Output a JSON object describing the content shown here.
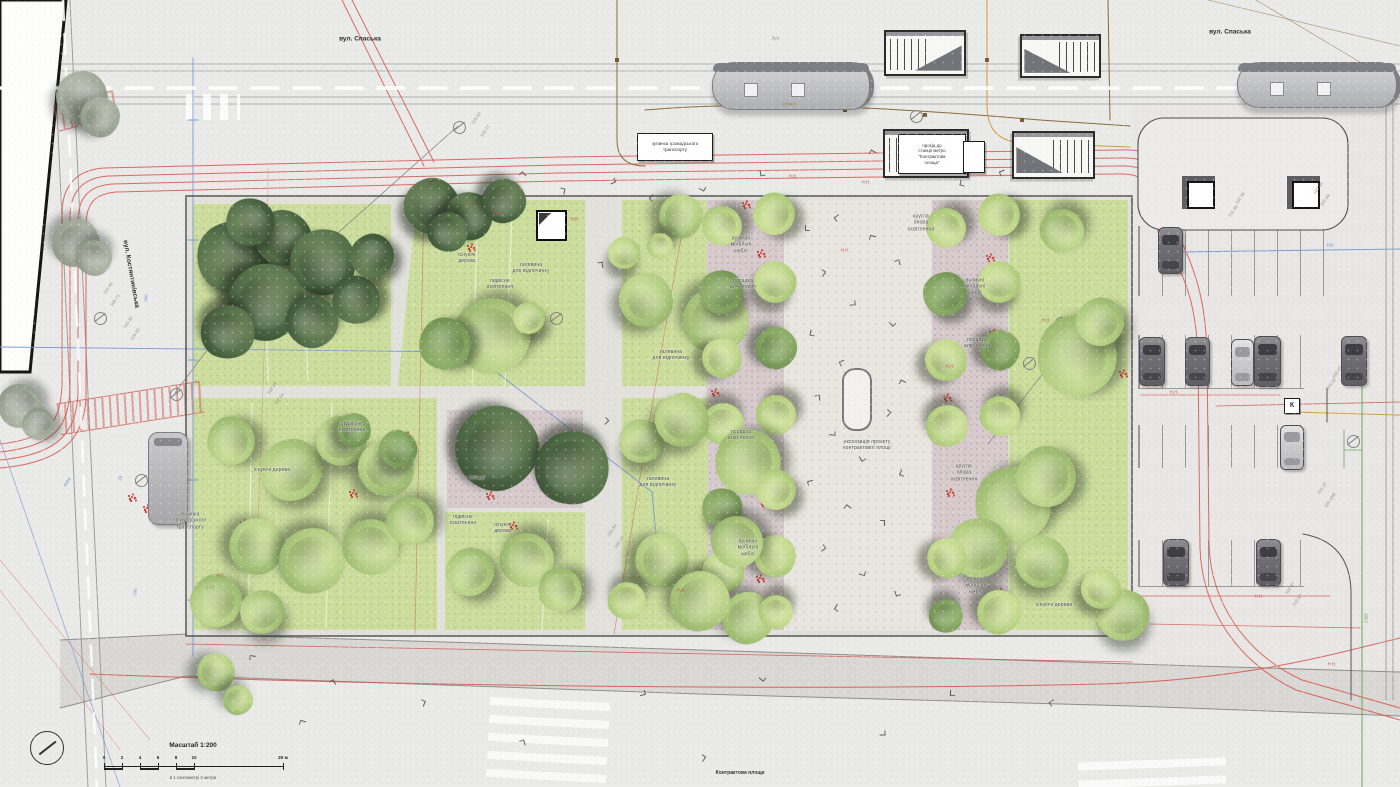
{
  "meta": {
    "scale_title": "Масштаб 1:200",
    "scale_caption": "в 1 сантиметрі  2  метри",
    "scale_ticks": [
      "0",
      "2",
      "4",
      "6",
      "8",
      "10",
      "20 м"
    ],
    "plan_caption": "Контрактова площа"
  },
  "colors": {
    "lawn": "#ccdd9d",
    "alley_paving": "#d7cbce",
    "tree_dark": "#4f6847",
    "tree_light": "#a9c57d",
    "red_utility_line": "#d9534a",
    "blue_geodetic_line": "#7a9ad1",
    "orange_utility_line": "#d99a3d",
    "green_utility_line": "#67a85b",
    "flowers": "#cf4038"
  },
  "street_labels": [
    {
      "t": "вул. Спаська",
      "x": 360,
      "y": 39,
      "rot": 0
    },
    {
      "t": "вул. Спаська",
      "x": 1230,
      "y": 32,
      "rot": 0
    },
    {
      "t": "вул. Костянтинівська",
      "x": 131,
      "y": 274,
      "rot": 80
    }
  ],
  "boxed_labels": [
    {
      "t": "зупинка громадського\nтранспорту",
      "x": 637,
      "y": 133,
      "w": 74,
      "h": 26,
      "fs": 4.6
    },
    {
      "t": "прохід до\nстанції метро\n\"Контрактова\nплоща\"",
      "x": 898,
      "y": 134,
      "w": 66,
      "h": 38,
      "fs": 4.4
    },
    {
      "t": "",
      "x": 963,
      "y": 141,
      "w": 20,
      "h": 30,
      "fs": 4
    },
    {
      "t": "К",
      "x": 1284,
      "y": 398,
      "w": 14,
      "h": 14,
      "fs": 7,
      "cls": "k"
    }
  ],
  "plan_labels": [
    {
      "t": "існуючі\nдерева",
      "x": 467,
      "y": 258
    },
    {
      "t": "галявина\nдля відпочинку",
      "x": 531,
      "y": 268
    },
    {
      "t": "підвісне\nосвітлення",
      "x": 500,
      "y": 284
    },
    {
      "t": "галявина\nдля відпочинку",
      "x": 671,
      "y": 355
    },
    {
      "t": "існуючі дерева",
      "x": 272,
      "y": 470
    },
    {
      "t": "підвісне\nосвітлення",
      "x": 352,
      "y": 427
    },
    {
      "t": "площа",
      "x": 477,
      "y": 478
    },
    {
      "t": "підвісне\nосвітлення",
      "x": 463,
      "y": 520
    },
    {
      "t": "існуючі\nдерева",
      "x": 503,
      "y": 528
    },
    {
      "t": "галявина\nдля відпочинку",
      "x": 658,
      "y": 482
    },
    {
      "t": "вуличні\nмобільні\nмеблі",
      "x": 741,
      "y": 245
    },
    {
      "t": "посадка\nалеї ясеня",
      "x": 743,
      "y": 284
    },
    {
      "t": "посадка\nалеї ясеня",
      "x": 741,
      "y": 435
    },
    {
      "t": "вуличні\nмобільні\nмеблі",
      "x": 748,
      "y": 548
    },
    {
      "t": "кругла\nопора\nосвітлення",
      "x": 921,
      "y": 223
    },
    {
      "t": "вуличні\nмобільні\nмеблі",
      "x": 975,
      "y": 287
    },
    {
      "t": "посадка\nалеї ясеня",
      "x": 977,
      "y": 343
    },
    {
      "t": "кругла\nопора\nосвітлення",
      "x": 964,
      "y": 473
    },
    {
      "t": "вуличні\nмобільні\nмеблі",
      "x": 976,
      "y": 586
    },
    {
      "t": "існуючі дерева",
      "x": 1054,
      "y": 605
    },
    {
      "t": "експозиція проекту\nконтрактової площі",
      "x": 867,
      "y": 445
    },
    {
      "t": "зупинка\nгромадського\nтранспорту",
      "x": 190,
      "y": 521
    }
  ],
  "tiny_labels": [
    {
      "t": "Н.Н.",
      "x": 497,
      "y": 213,
      "rot": 0,
      "c": "red"
    },
    {
      "t": "Н.Н.",
      "x": 575,
      "y": 219,
      "rot": 0,
      "c": "red"
    },
    {
      "t": "Н.Н.",
      "x": 845,
      "y": 250,
      "rot": 0,
      "c": "red"
    },
    {
      "t": "Н.Н.",
      "x": 866,
      "y": 182,
      "rot": 0,
      "c": "red"
    },
    {
      "t": "Н.Н.",
      "x": 950,
      "y": 366,
      "rot": 0,
      "c": "red"
    },
    {
      "t": "Н.Н.",
      "x": 1046,
      "y": 320,
      "rot": 0,
      "c": "red"
    },
    {
      "t": "Н.Н.",
      "x": 1174,
      "y": 392,
      "rot": 0,
      "c": "red"
    },
    {
      "t": "Н.Н.",
      "x": 1259,
      "y": 596,
      "rot": 0,
      "c": "red"
    },
    {
      "t": "Н.Н.",
      "x": 1332,
      "y": 664,
      "rot": 0,
      "c": "red"
    },
    {
      "t": "Н.Н.",
      "x": 681,
      "y": 590,
      "rot": 0,
      "c": "red"
    },
    {
      "t": "Н.Н.",
      "x": 221,
      "y": 575,
      "rot": 0,
      "c": "red"
    },
    {
      "t": "Н.Н.",
      "x": 793,
      "y": 176,
      "rot": 0,
      "c": "red"
    },
    {
      "t": "103.50",
      "x": 476,
      "y": 118,
      "rot": -55,
      "c": "grey"
    },
    {
      "t": "100.77",
      "x": 485,
      "y": 131,
      "rot": -55,
      "c": "grey"
    },
    {
      "t": "102.49",
      "x": 272,
      "y": 388,
      "rot": -55,
      "c": "grey"
    },
    {
      "t": "102.54",
      "x": 279,
      "y": 399,
      "rot": -55,
      "c": "grey"
    },
    {
      "t": "101.92",
      "x": 128,
      "y": 322,
      "rot": -55,
      "c": "grey"
    },
    {
      "t": "100.93",
      "x": 135,
      "y": 334,
      "rot": -55,
      "c": "grey"
    },
    {
      "t": "102.36",
      "x": 1240,
      "y": 198,
      "rot": -55,
      "c": "grey"
    },
    {
      "t": "101.86",
      "x": 1233,
      "y": 211,
      "rot": -55,
      "c": "grey"
    },
    {
      "t": "103.05",
      "x": 1318,
      "y": 188,
      "rot": -55,
      "c": "grey"
    },
    {
      "t": "102.09",
      "x": 1325,
      "y": 200,
      "rot": -55,
      "c": "grey"
    },
    {
      "t": "100.47",
      "x": 1337,
      "y": 372,
      "rot": -55,
      "c": "grey"
    },
    {
      "t": "100.32",
      "x": 1331,
      "y": 384,
      "rot": -55,
      "c": "grey"
    },
    {
      "t": "102.87",
      "x": 1290,
      "y": 588,
      "rot": -55,
      "c": "grey"
    },
    {
      "t": "102.52",
      "x": 1297,
      "y": 600,
      "rot": -55,
      "c": "grey"
    },
    {
      "t": "101.37",
      "x": 1322,
      "y": 488,
      "rot": -55,
      "c": "grey"
    },
    {
      "t": "101.16М",
      "x": 1330,
      "y": 500,
      "rot": -55,
      "c": "grey"
    },
    {
      "t": "103.84",
      "x": 612,
      "y": 530,
      "rot": -55,
      "c": "grey"
    },
    {
      "t": "102.14",
      "x": 619,
      "y": 542,
      "rot": -55,
      "c": "grey"
    },
    {
      "t": "102.45",
      "x": 108,
      "y": 288,
      "rot": -55,
      "c": "grey"
    },
    {
      "t": "100.71",
      "x": 115,
      "y": 300,
      "rot": -55,
      "c": "grey"
    },
    {
      "t": "1.53",
      "x": 210,
      "y": 587,
      "rot": 0,
      "c": "grey"
    },
    {
      "t": "300",
      "x": 146,
      "y": 298,
      "rot": -83,
      "c": "blue"
    },
    {
      "t": "200",
      "x": 135,
      "y": 592,
      "rot": -83,
      "c": "blue"
    },
    {
      "t": "100",
      "x": 1330,
      "y": 245,
      "rot": 0,
      "c": "blue"
    },
    {
      "t": "28",
      "x": 120,
      "y": 478,
      "rot": -83,
      "c": "blue"
    },
    {
      "t": "450м",
      "x": 67,
      "y": 482,
      "rot": -60,
      "c": "blue"
    },
    {
      "t": "200м.п.",
      "x": 790,
      "y": 104,
      "rot": -3,
      "c": "brown"
    },
    {
      "t": "Зул.",
      "x": 776,
      "y": 38,
      "rot": 0,
      "c": "grey"
    },
    {
      "t": "2308",
      "x": 1366,
      "y": 618,
      "rot": -90,
      "c": "green"
    }
  ],
  "trees": [
    [
      82,
      97,
      26,
      "grey"
    ],
    [
      100,
      117,
      20,
      "grey"
    ],
    [
      76,
      243,
      24,
      "grey"
    ],
    [
      94,
      258,
      18,
      "grey"
    ],
    [
      20,
      406,
      22,
      "grey"
    ],
    [
      38,
      424,
      16,
      "grey"
    ],
    [
      233,
      257,
      36,
      "dark"
    ],
    [
      283,
      238,
      28,
      "dark"
    ],
    [
      323,
      262,
      33,
      "dark"
    ],
    [
      266,
      302,
      38,
      "dark"
    ],
    [
      228,
      332,
      27,
      "dark"
    ],
    [
      312,
      322,
      26,
      "dark"
    ],
    [
      356,
      300,
      24,
      "dark"
    ],
    [
      372,
      256,
      22,
      "dark"
    ],
    [
      250,
      222,
      24,
      "dark"
    ],
    [
      432,
      206,
      28,
      "dark"
    ],
    [
      469,
      216,
      24,
      "dark"
    ],
    [
      504,
      201,
      22,
      "dark"
    ],
    [
      448,
      232,
      20,
      "dark"
    ],
    [
      492,
      336,
      38,
      "light"
    ],
    [
      445,
      344,
      26,
      "mid"
    ],
    [
      529,
      318,
      16,
      "lime"
    ],
    [
      624,
      253,
      16,
      "lime"
    ],
    [
      646,
      300,
      27,
      "light"
    ],
    [
      681,
      216,
      22,
      "light"
    ],
    [
      716,
      320,
      33,
      "light"
    ],
    [
      660,
      246,
      13,
      "lime"
    ],
    [
      722,
      226,
      20,
      "lime"
    ],
    [
      774,
      214,
      21,
      "lime"
    ],
    [
      721,
      292,
      22,
      "mid"
    ],
    [
      775,
      282,
      21,
      "lime"
    ],
    [
      722,
      358,
      20,
      "lime"
    ],
    [
      776,
      348,
      21,
      "mid"
    ],
    [
      723,
      424,
      21,
      "lime"
    ],
    [
      776,
      415,
      20,
      "lime"
    ],
    [
      748,
      462,
      33,
      "light"
    ],
    [
      776,
      490,
      20,
      "lime"
    ],
    [
      722,
      508,
      20,
      "mid"
    ],
    [
      723,
      572,
      21,
      "lime"
    ],
    [
      775,
      556,
      21,
      "lime"
    ],
    [
      748,
      618,
      26,
      "light"
    ],
    [
      776,
      612,
      17,
      "lime"
    ],
    [
      737,
      542,
      26,
      "light"
    ],
    [
      231,
      441,
      24,
      "light"
    ],
    [
      291,
      470,
      31,
      "light"
    ],
    [
      341,
      441,
      25,
      "light"
    ],
    [
      386,
      468,
      28,
      "light"
    ],
    [
      257,
      546,
      28,
      "light"
    ],
    [
      312,
      561,
      33,
      "light"
    ],
    [
      371,
      547,
      28,
      "light"
    ],
    [
      410,
      521,
      24,
      "light"
    ],
    [
      216,
      601,
      26,
      "light"
    ],
    [
      262,
      612,
      22,
      "light"
    ],
    [
      398,
      449,
      19,
      "mid"
    ],
    [
      354,
      430,
      17,
      "mid"
    ],
    [
      497,
      448,
      42,
      "dark"
    ],
    [
      572,
      468,
      37,
      "dark"
    ],
    [
      527,
      560,
      27,
      "light"
    ],
    [
      560,
      590,
      22,
      "light"
    ],
    [
      470,
      572,
      24,
      "light"
    ],
    [
      641,
      441,
      22,
      "light"
    ],
    [
      682,
      420,
      27,
      "light"
    ],
    [
      662,
      560,
      27,
      "light"
    ],
    [
      700,
      601,
      30,
      "light"
    ],
    [
      627,
      601,
      19,
      "lime"
    ],
    [
      946,
      228,
      20,
      "lime"
    ],
    [
      999,
      215,
      21,
      "lime"
    ],
    [
      945,
      294,
      22,
      "mid"
    ],
    [
      999,
      282,
      21,
      "lime"
    ],
    [
      946,
      360,
      21,
      "lime"
    ],
    [
      1000,
      350,
      20,
      "mid"
    ],
    [
      947,
      426,
      21,
      "lime"
    ],
    [
      1000,
      416,
      20,
      "lime"
    ],
    [
      1013,
      505,
      38,
      "light"
    ],
    [
      1046,
      477,
      30,
      "light"
    ],
    [
      978,
      548,
      30,
      "light"
    ],
    [
      1042,
      562,
      26,
      "light"
    ],
    [
      947,
      558,
      20,
      "lime"
    ],
    [
      999,
      612,
      22,
      "lime"
    ],
    [
      946,
      616,
      17,
      "mid"
    ],
    [
      1062,
      231,
      22,
      "light"
    ],
    [
      1077,
      356,
      40,
      "light"
    ],
    [
      1100,
      322,
      24,
      "light"
    ],
    [
      1123,
      615,
      26,
      "light"
    ],
    [
      1101,
      589,
      20,
      "lime"
    ],
    [
      216,
      672,
      19,
      "light"
    ],
    [
      238,
      700,
      15,
      "light"
    ]
  ],
  "flowers": [
    [
      287,
      241
    ],
    [
      470,
      246
    ],
    [
      406,
      434
    ],
    [
      392,
      447
    ],
    [
      489,
      494
    ],
    [
      512,
      524
    ],
    [
      131,
      496
    ],
    [
      146,
      507
    ],
    [
      713,
      226
    ],
    [
      760,
      252
    ],
    [
      718,
      300
    ],
    [
      769,
      331
    ],
    [
      714,
      391
    ],
    [
      764,
      421
    ],
    [
      719,
      469
    ],
    [
      763,
      501
    ],
    [
      717,
      546
    ],
    [
      759,
      577
    ],
    [
      727,
      611
    ],
    [
      745,
      203
    ],
    [
      941,
      231
    ],
    [
      989,
      256
    ],
    [
      944,
      301
    ],
    [
      992,
      332
    ],
    [
      946,
      396
    ],
    [
      994,
      426
    ],
    [
      949,
      491
    ],
    [
      997,
      521
    ],
    [
      951,
      561
    ],
    [
      999,
      591
    ],
    [
      1078,
      226
    ],
    [
      1077,
      323
    ],
    [
      1014,
      481
    ],
    [
      1031,
      556
    ],
    [
      1122,
      372
    ],
    [
      641,
      276
    ],
    [
      628,
      292
    ],
    [
      352,
      492
    ],
    [
      243,
      522
    ],
    [
      374,
      556
    ]
  ],
  "people": [
    [
      805,
      225
    ],
    [
      835,
      215
    ],
    [
      870,
      235
    ],
    [
      895,
      260
    ],
    [
      820,
      270
    ],
    [
      850,
      300
    ],
    [
      890,
      320
    ],
    [
      810,
      330
    ],
    [
      840,
      360
    ],
    [
      900,
      380
    ],
    [
      815,
      395
    ],
    [
      885,
      410
    ],
    [
      830,
      430
    ],
    [
      860,
      455
    ],
    [
      900,
      470
    ],
    [
      808,
      480
    ],
    [
      845,
      505
    ],
    [
      880,
      520
    ],
    [
      820,
      545
    ],
    [
      860,
      570
    ],
    [
      895,
      590
    ],
    [
      835,
      605
    ],
    [
      430,
      180
    ],
    [
      520,
      172
    ],
    [
      560,
      188
    ],
    [
      610,
      178
    ],
    [
      700,
      185
    ],
    [
      760,
      170
    ],
    [
      650,
      195
    ],
    [
      250,
      655
    ],
    [
      330,
      680
    ],
    [
      420,
      700
    ],
    [
      640,
      690
    ],
    [
      760,
      675
    ],
    [
      950,
      690
    ],
    [
      1050,
      700
    ],
    [
      300,
      720
    ],
    [
      520,
      740
    ],
    [
      700,
      755
    ],
    [
      880,
      730
    ],
    [
      925,
      137
    ],
    [
      960,
      180
    ],
    [
      1000,
      170
    ],
    [
      870,
      150
    ],
    [
      598,
      262
    ],
    [
      603,
      418
    ]
  ],
  "objects": {
    "trams": [
      {
        "x": 712,
        "y": 62,
        "w": 156,
        "h": 46
      },
      {
        "x": 1237,
        "y": 62,
        "w": 158,
        "h": 44
      }
    ],
    "bus": {
      "x": 148,
      "y": 432,
      "w": 38,
      "h": 91
    },
    "cars": [
      {
        "x": 1158,
        "y": 227,
        "w": 23,
        "h": 45,
        "tone": "dark"
      },
      {
        "x": 1139,
        "y": 337,
        "w": 24,
        "h": 47,
        "tone": "dark"
      },
      {
        "x": 1185,
        "y": 337,
        "w": 23,
        "h": 47,
        "tone": "dark"
      },
      {
        "x": 1231,
        "y": 339,
        "w": 21,
        "h": 45,
        "tone": "light"
      },
      {
        "x": 1254,
        "y": 336,
        "w": 25,
        "h": 49,
        "tone": "dark"
      },
      {
        "x": 1341,
        "y": 336,
        "w": 24,
        "h": 48,
        "tone": "dark"
      },
      {
        "x": 1280,
        "y": 425,
        "w": 22,
        "h": 43,
        "tone": "light"
      },
      {
        "x": 1163,
        "y": 539,
        "w": 24,
        "h": 45,
        "tone": "dark"
      },
      {
        "x": 1256,
        "y": 539,
        "w": 23,
        "h": 45,
        "tone": "dark"
      }
    ],
    "metro_entrances": [
      {
        "x": 884,
        "y": 30,
        "w": 78,
        "h": 42,
        "flip": false
      },
      {
        "x": 1020,
        "y": 34,
        "w": 77,
        "h": 40,
        "flip": true
      },
      {
        "x": 883,
        "y": 129,
        "w": 82,
        "h": 45,
        "flip": false
      },
      {
        "x": 1012,
        "y": 131,
        "w": 79,
        "h": 44,
        "flip": true
      }
    ],
    "kiosk_cubes": [
      {
        "x": 1182,
        "y": 176,
        "s": 33
      },
      {
        "x": 1287,
        "y": 176,
        "s": 33
      }
    ],
    "park_kiosk": {
      "x": 536,
      "y": 210,
      "s": 27
    },
    "exhibit_stand": {
      "x": 842,
      "y": 368,
      "w": 26,
      "h": 59
    },
    "survey_points": [
      [
        458,
        126
      ],
      [
        312,
        256
      ],
      [
        1060,
        322
      ],
      [
        1028,
        362
      ],
      [
        140,
        479
      ],
      [
        175,
        393
      ],
      [
        99,
        317
      ],
      [
        915,
        115
      ],
      [
        555,
        317
      ],
      [
        1352,
        440
      ]
    ]
  }
}
